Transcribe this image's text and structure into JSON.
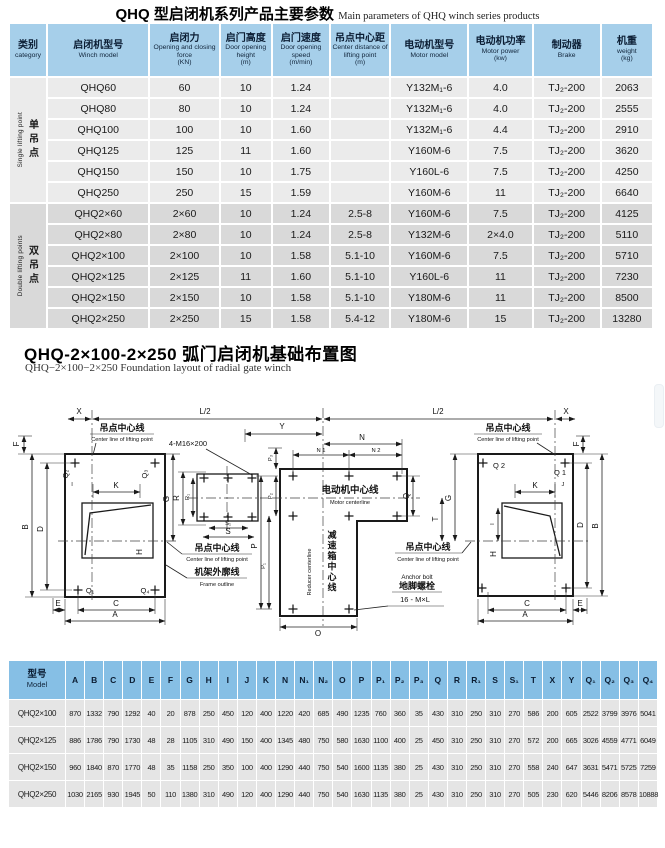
{
  "section1": {
    "title_zh": "QHQ 型启闭机系列产品主要参数",
    "title_en": "Main parameters of QHQ winch series products"
  },
  "table1": {
    "headers": [
      {
        "zh": "类别",
        "en": "category"
      },
      {
        "zh": "启闭机型号",
        "en": "Winch model"
      },
      {
        "zh": "启闭力",
        "en": "Opening and closing force",
        "unit": "(KN)"
      },
      {
        "zh": "启门高度",
        "en": "Door opening height",
        "unit": "(m)"
      },
      {
        "zh": "启门速度",
        "en": "Door opening speed",
        "unit": "(m/min)"
      },
      {
        "zh": "吊点中心距",
        "en": "Center distance of lifting point",
        "unit": "(m)"
      },
      {
        "zh": "电动机型号",
        "en": "Motor model"
      },
      {
        "zh": "电动机功率",
        "en": "Motor power",
        "unit": "(kw)"
      },
      {
        "zh": "制动器",
        "en": "Brake"
      },
      {
        "zh": "机重",
        "en": "weight",
        "unit": "(kg)"
      }
    ],
    "groups": [
      {
        "category_zh": "单吊点",
        "category_en": "Single lifting point",
        "rows": [
          [
            "QHQ60",
            "60",
            "10",
            "1.24",
            "",
            "Y132M₁-6",
            "4.0",
            "TJ₂-200",
            "2063"
          ],
          [
            "QHQ80",
            "80",
            "10",
            "1.24",
            "",
            "Y132M₁-6",
            "4.0",
            "TJ₂-200",
            "2555"
          ],
          [
            "QHQ100",
            "100",
            "10",
            "1.60",
            "",
            "Y132M₁-6",
            "4.4",
            "TJ₂-200",
            "2910"
          ],
          [
            "QHQ125",
            "125",
            "11",
            "1.60",
            "",
            "Y160M-6",
            "7.5",
            "TJ₂-200",
            "3620"
          ],
          [
            "QHQ150",
            "150",
            "10",
            "1.75",
            "",
            "Y160L-6",
            "7.5",
            "TJ₂-200",
            "4250"
          ],
          [
            "QHQ250",
            "250",
            "15",
            "1.59",
            "",
            "Y160M-6",
            "11",
            "TJ₂-200",
            "6640"
          ]
        ]
      },
      {
        "category_zh": "双吊点",
        "category_en": "Double lifting points",
        "rows": [
          [
            "QHQ2×60",
            "2×60",
            "10",
            "1.24",
            "2.5-8",
            "Y160M-6",
            "7.5",
            "TJ₂-200",
            "4125"
          ],
          [
            "QHQ2×80",
            "2×80",
            "10",
            "1.24",
            "2.5-8",
            "Y132M-6",
            "2×4.0",
            "TJ₂-200",
            "5110"
          ],
          [
            "QHQ2×100",
            "2×100",
            "10",
            "1.58",
            "5.1-10",
            "Y160M-6",
            "7.5",
            "TJ₂-200",
            "5710"
          ],
          [
            "QHQ2×125",
            "2×125",
            "11",
            "1.60",
            "5.1-10",
            "Y160L-6",
            "11",
            "TJ₂-200",
            "7230"
          ],
          [
            "QHQ2×150",
            "2×150",
            "10",
            "1.58",
            "5.1-10",
            "Y180M-6",
            "11",
            "TJ₂-200",
            "8500"
          ],
          [
            "QHQ2×250",
            "2×250",
            "15",
            "1.58",
            "5.4-12",
            "Y180M-6",
            "15",
            "TJ₂-200",
            "13280"
          ]
        ]
      }
    ]
  },
  "section2": {
    "title_zh": "QHQ-2×100-2×250 弧门启闭机基础布置图",
    "title_en": "QHQ−2×100−2×250 Foundation layout of radial gate winch"
  },
  "diagram": {
    "dims": {
      "l2": "L/2",
      "x": "X",
      "f": "F",
      "b": "B",
      "d": "D",
      "e": "E",
      "c": "C",
      "a": "A",
      "k": "K",
      "i": "I",
      "j": "J",
      "h": "H",
      "g": "G",
      "r": "R",
      "r1": "R₁",
      "s": "S",
      "s1": "S₁",
      "t": "T",
      "y": "Y",
      "n": "N",
      "n1": "N 1",
      "n2": "N 2",
      "o": "O",
      "p": "P",
      "p1": "P₁",
      "p2": "P₂",
      "p3": "P₃",
      "q": "Q",
      "q1": "Q 1",
      "q2": "Q 2",
      "q1b": "Q₁",
      "q2b": "Q₂",
      "q3b": "Q₃",
      "q4b": "Q₄"
    },
    "callouts": {
      "lifting_zh": "吊点中心线",
      "lifting_en": "Center line of lifting point",
      "motor_zh": "电动机中心线",
      "motor_en": "Motor centerline",
      "reducer_zh": "减速箱中心线",
      "reducer_en": "Reducer centerline",
      "frame_zh": "机架外廓线",
      "frame_en": "Frame outline",
      "anchor_en": "Anchor bolt",
      "anchor_zh": "地脚螺栓",
      "anchor_spec": "16 - M×L",
      "bolt_spec": "4-M16×200"
    }
  },
  "table2": {
    "model_header": {
      "zh": "型号",
      "en": "Model"
    },
    "headers": [
      "A",
      "B",
      "C",
      "D",
      "E",
      "F",
      "G",
      "H",
      "I",
      "J",
      "K",
      "N",
      "N₁",
      "N₂",
      "O",
      "P",
      "P₁",
      "P₂",
      "P₃",
      "Q",
      "R",
      "R₁",
      "S",
      "S₁",
      "T",
      "X",
      "Y",
      "Q₁",
      "Q₂",
      "Q₃",
      "Q₄"
    ],
    "rows": [
      {
        "model": "QHQ2×100",
        "values": [
          "870",
          "1332",
          "790",
          "1292",
          "40",
          "20",
          "878",
          "250",
          "450",
          "120",
          "400",
          "1220",
          "420",
          "685",
          "490",
          "1235",
          "760",
          "360",
          "35",
          "430",
          "310",
          "250",
          "310",
          "270",
          "586",
          "200",
          "605",
          "2522",
          "3799",
          "3976",
          "5041"
        ]
      },
      {
        "model": "QHQ2×125",
        "values": [
          "886",
          "1786",
          "790",
          "1730",
          "48",
          "28",
          "1105",
          "310",
          "490",
          "150",
          "400",
          "1345",
          "480",
          "750",
          "580",
          "1630",
          "1100",
          "400",
          "25",
          "450",
          "310",
          "250",
          "310",
          "270",
          "572",
          "200",
          "665",
          "3026",
          "4559",
          "4771",
          "6049"
        ]
      },
      {
        "model": "QHQ2×150",
        "values": [
          "960",
          "1840",
          "870",
          "1770",
          "48",
          "35",
          "1158",
          "250",
          "350",
          "100",
          "400",
          "1290",
          "440",
          "750",
          "540",
          "1600",
          "1135",
          "380",
          "25",
          "430",
          "310",
          "250",
          "310",
          "270",
          "558",
          "240",
          "647",
          "3631",
          "5471",
          "5725",
          "7259"
        ]
      },
      {
        "model": "QHQ2×250",
        "values": [
          "1030",
          "2165",
          "930",
          "1945",
          "50",
          "110",
          "1380",
          "310",
          "490",
          "120",
          "400",
          "1290",
          "440",
          "750",
          "540",
          "1630",
          "1135",
          "380",
          "25",
          "430",
          "310",
          "250",
          "310",
          "270",
          "505",
          "230",
          "620",
          "5446",
          "8206",
          "8578",
          "10888"
        ]
      }
    ]
  }
}
